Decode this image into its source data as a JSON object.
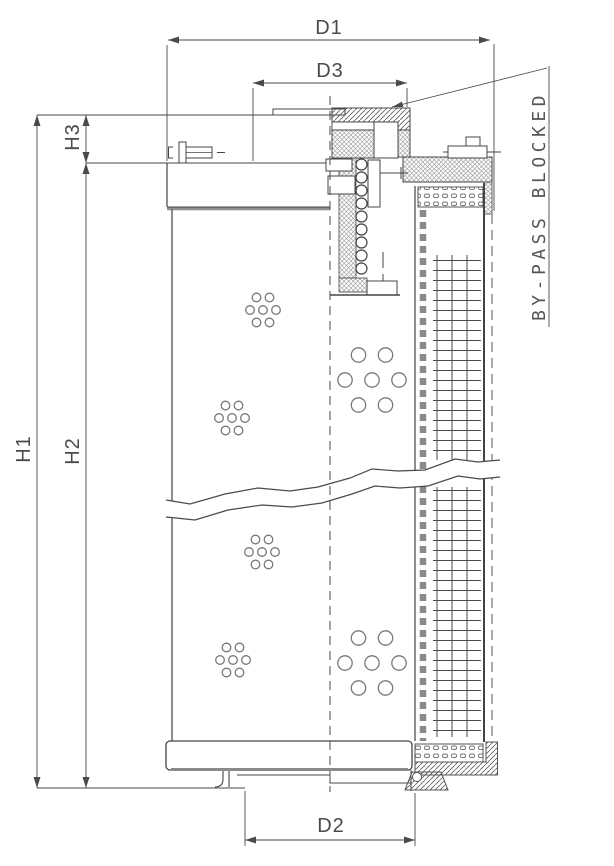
{
  "drawing": {
    "ink_color": "#4a4a4a",
    "labels": {
      "d1": "D1",
      "d3": "D3",
      "d2": "D2",
      "h1": "H1",
      "h2": "H2",
      "h3": "H3"
    },
    "annotations": {
      "bypass_note": "BY-PASS BLOCKED"
    }
  }
}
